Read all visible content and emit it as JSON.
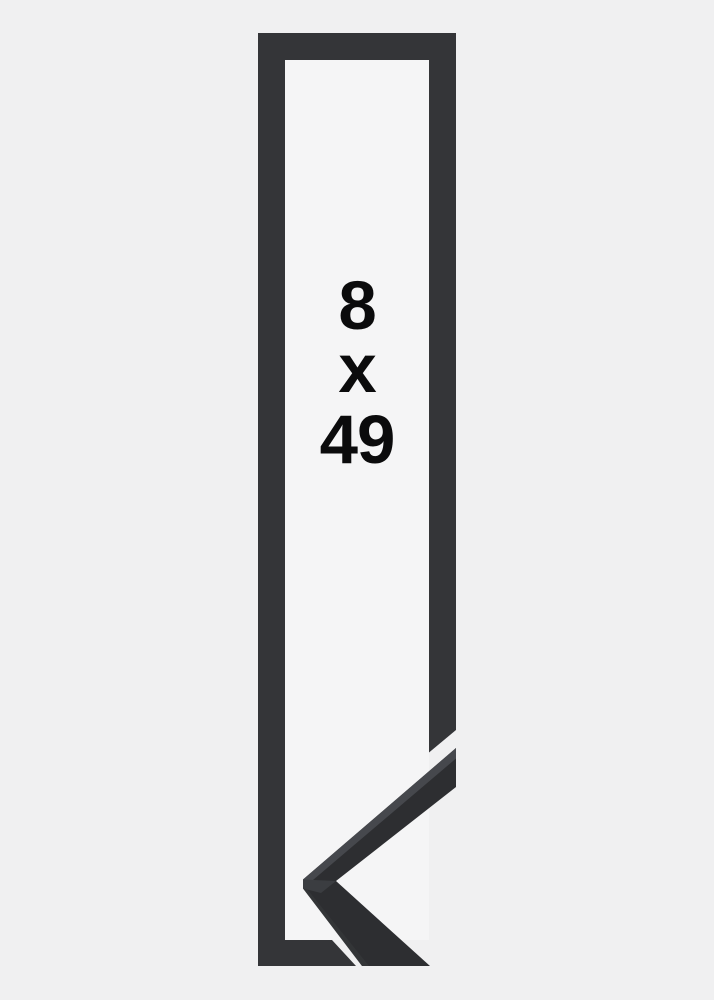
{
  "dimensions": {
    "width_value": "8",
    "separator": "x",
    "height_value": "49"
  },
  "colors": {
    "background": "#f0f0f1",
    "interior": "#f5f5f6",
    "frame_outline": "#343538",
    "profile_front": "#2d2e31",
    "profile_top_face": "#46484d",
    "profile_corner_facet": "#3b3d41",
    "dimension_text": "#0b0b0c"
  }
}
